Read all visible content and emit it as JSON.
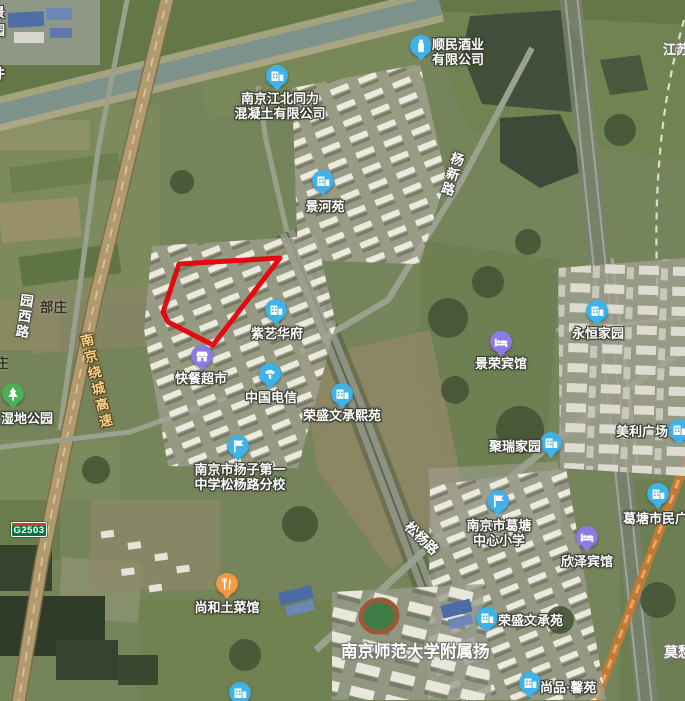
{
  "map": {
    "view_type": "satellite",
    "highlight_polygon": {
      "color": "#e8000a",
      "stroke_width": 5,
      "points": [
        [
          179,
          264
        ],
        [
          280,
          258
        ],
        [
          213,
          345
        ],
        [
          168,
          322
        ],
        [
          163,
          312
        ]
      ]
    },
    "road_shield": {
      "code": "G2503",
      "bg_color": "#007b40",
      "stripe_color": "#d03a2a",
      "x": 11,
      "y": 522
    },
    "marker_colors": {
      "blue": "#3fb3e8",
      "purple": "#8e7ce6",
      "orange": "#f59a42",
      "green": "#4db056"
    },
    "markers": [
      {
        "id": "shunmin-liquor-company",
        "label": "顺民酒业\n有限公司",
        "icon": "liquor-company-icon",
        "color": "#3fb3e8",
        "x": 421,
        "y": 46,
        "label_pos": "right",
        "lx": 11,
        "ly": -9
      },
      {
        "id": "tongli-concrete-company",
        "label": "南京江北同力\n混凝土有限公司",
        "icon": "building-icon",
        "color": "#3fb3e8",
        "x": 277,
        "y": 76,
        "label_pos": "below",
        "dx": 3,
        "ly": 15
      },
      {
        "id": "jingheyuan",
        "label": "景河苑",
        "icon": "building-icon",
        "color": "#3fb3e8",
        "x": 323,
        "y": 181,
        "label_pos": "below",
        "dx": 2,
        "ly": 18
      },
      {
        "id": "ziyi-huafu",
        "label": "紫艺华府",
        "icon": "building-icon",
        "color": "#3fb3e8",
        "x": 276,
        "y": 310,
        "label_pos": "below",
        "dx": 1,
        "ly": 16
      },
      {
        "id": "kuaican-supermarket",
        "label": "快餐超市",
        "icon": "store-icon",
        "color": "#8e7ce6",
        "x": 202,
        "y": 356,
        "label_pos": "below",
        "dx": -1,
        "ly": 15
      },
      {
        "id": "china-telecom",
        "label": "中国电信",
        "icon": "telecom-icon",
        "color": "#3fb3e8",
        "x": 270,
        "y": 374,
        "label_pos": "below",
        "dx": 1,
        "ly": 16
      },
      {
        "id": "rongsheng-wencheng-xiyuan",
        "label": "荣盛文承熙苑",
        "icon": "building-icon",
        "color": "#3fb3e8",
        "x": 342,
        "y": 394,
        "label_pos": "below",
        "dx": 0,
        "ly": 14
      },
      {
        "id": "yangzi-no1-middle-school-songyang-branch",
        "label": "南京市扬子第一\n中学松杨路分校",
        "icon": "school-flag-icon",
        "color": "#3fb3e8",
        "x": 238,
        "y": 446,
        "label_pos": "below",
        "dx": 2,
        "ly": 16
      },
      {
        "id": "yongheng-jiayuan",
        "label": "永恒家园",
        "icon": "building-icon",
        "color": "#3fb3e8",
        "x": 597,
        "y": 311,
        "label_pos": "below",
        "dx": 1,
        "ly": 15
      },
      {
        "id": "jingrong-hotel",
        "label": "景荣宾馆",
        "icon": "hotel-bed-icon",
        "color": "#8e7ce6",
        "x": 501,
        "y": 342,
        "label_pos": "below",
        "dx": 0,
        "ly": 14
      },
      {
        "id": "meili-plaza",
        "label": "美利广场",
        "icon": "building-icon",
        "color": "#3fb3e8",
        "x": 679,
        "y": 430,
        "label_pos": "left",
        "rx": 11,
        "ly": -6
      },
      {
        "id": "jurui-jiayuan",
        "label": "聚瑞家园",
        "icon": "building-icon",
        "color": "#3fb3e8",
        "x": 551,
        "y": 443,
        "label_pos": "left",
        "rx": 10,
        "ly": -4
      },
      {
        "id": "getang-central-primary-school",
        "label": "南京市葛塘\n中心小学",
        "icon": "school-flag-icon",
        "color": "#3fb3e8",
        "x": 498,
        "y": 501,
        "label_pos": "below",
        "dx": 1,
        "ly": 17
      },
      {
        "id": "xinze-hotel",
        "label": "欣泽宾馆",
        "icon": "hotel-bed-icon",
        "color": "#8e7ce6",
        "x": 587,
        "y": 537,
        "label_pos": "below",
        "dx": 0,
        "ly": 17
      },
      {
        "id": "getang-civic-plaza",
        "label": "葛塘市民广场",
        "icon": "building-icon",
        "color": "#3fb3e8",
        "x": 658,
        "y": 494,
        "label_pos": "below",
        "dx": 4,
        "ly": 17
      },
      {
        "id": "shanghe-restaurant",
        "label": "尚和土菜馆",
        "icon": "restaurant-icon",
        "color": "#f59a42",
        "x": 227,
        "y": 584,
        "label_pos": "below",
        "dx": 0,
        "ly": 16
      },
      {
        "id": "rongsheng-wenchengyuan",
        "label": "荣盛文承苑",
        "icon": "building-icon",
        "color": "#3fb3e8",
        "x": 487,
        "y": 618,
        "label_pos": "right",
        "lx": 11,
        "ly": -5
      },
      {
        "id": "shangpin-xinyuan",
        "label": "尚品·馨苑",
        "icon": "building-icon",
        "color": "#3fb3e8",
        "x": 530,
        "y": 683,
        "label_pos": "right",
        "lx": 10,
        "ly": -3
      },
      {
        "id": "wetland-park",
        "label": "湿地公园",
        "icon": "park-tree-icon",
        "color": "#4db056",
        "x": 13,
        "y": 394,
        "label_pos": "below",
        "dx": 14,
        "ly": 17
      },
      {
        "id": "edge-clipped-poi",
        "label": "",
        "icon": "building-icon",
        "color": "#3fb3e8",
        "x": 240,
        "y": 693,
        "label_pos": "below",
        "dx": 0,
        "ly": 16
      }
    ],
    "road_labels": [
      {
        "id": "yuanxi-road",
        "text": "园西路",
        "orientation": "vertical",
        "x": 16,
        "y": 292,
        "rotation": 8,
        "style": "white"
      },
      {
        "id": "songyang-road",
        "text": "松杨路",
        "orientation": "horizontal",
        "x": 415,
        "y": 516,
        "rotation": 44,
        "style": "white"
      },
      {
        "id": "yangxin-road",
        "text": "杨新路",
        "orientation": "vertical",
        "x": 448,
        "y": 149,
        "rotation": 17,
        "style": "white"
      },
      {
        "id": "nanjing-ring-expressway",
        "text": "南京绕城高速",
        "orientation": "vertical",
        "x": 74,
        "y": 336,
        "rotation": -13,
        "style": "expressway-yellow"
      }
    ],
    "area_labels": [
      {
        "id": "nanjing-normal-univ-affiliated-yang",
        "text": "南京师范大学附属扬",
        "x": 341,
        "y": 638,
        "size": 16.5
      },
      {
        "id": "mochou-edge-partial",
        "text": "莫愁",
        "x": 664,
        "y": 642,
        "size": 14
      },
      {
        "id": "jiangsu-edge-partial",
        "text": "江苏",
        "x": 663,
        "y": 39,
        "size": 13
      }
    ],
    "village_labels": [
      {
        "id": "buzhuang",
        "text": "部庄",
        "x": 40,
        "y": 296
      },
      {
        "id": "zhuang-edge-partial",
        "text": "庄",
        "x": -5,
        "y": 352
      }
    ],
    "edge_partial_labels": [
      {
        "char": "景",
        "x": -8,
        "y": 2
      },
      {
        "char": "园",
        "x": -8,
        "y": 20
      },
      {
        "char": "件",
        "x": -8,
        "y": 63
      }
    ]
  }
}
